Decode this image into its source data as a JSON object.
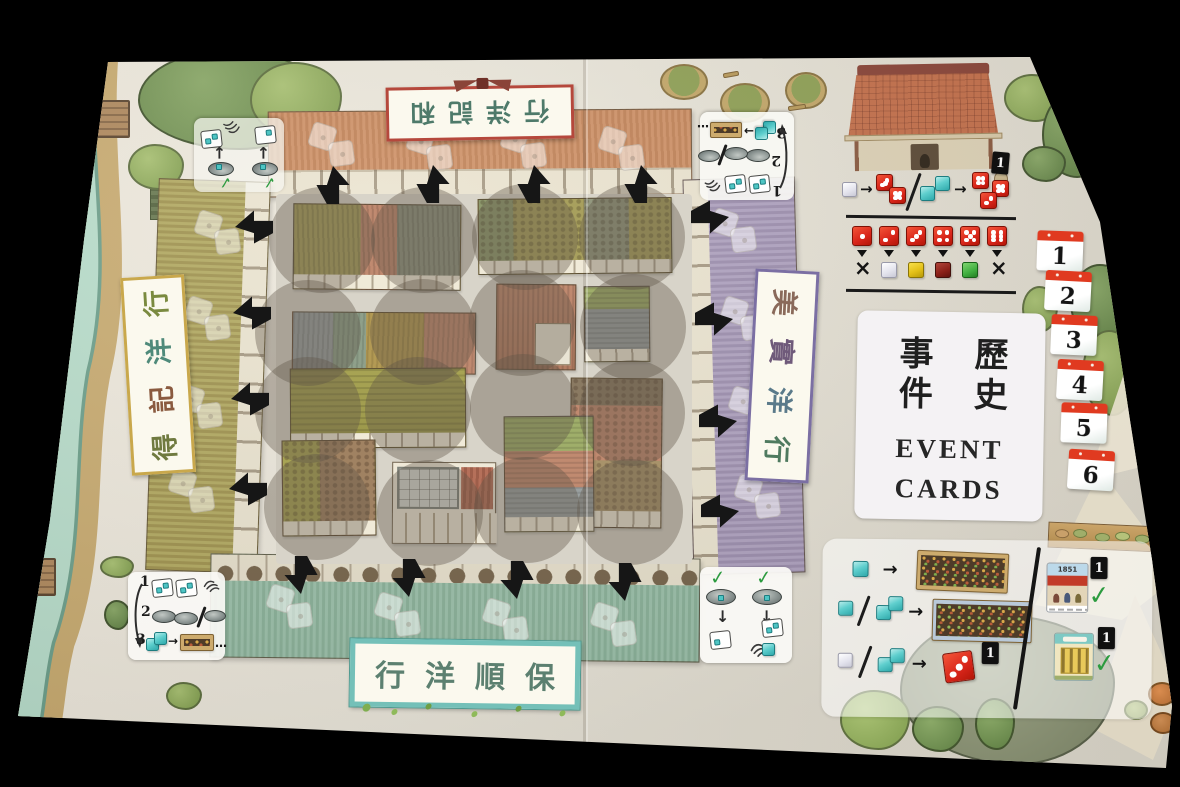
{
  "banners": {
    "top": {
      "display": "行洋記和",
      "company": "和記洋行"
    },
    "left": {
      "chars": [
        "行",
        "洋",
        "記",
        "得"
      ],
      "company": "得記洋行"
    },
    "right": {
      "chars": [
        "美",
        "實",
        "洋",
        "行"
      ],
      "company": "美實洋行"
    },
    "bottom": {
      "display": "行洋順保",
      "company": "保順洋行"
    }
  },
  "event_card": {
    "zh_left": "事件",
    "zh_right": "歷史",
    "en_line1": "EVENT",
    "en_line2": "CARDS"
  },
  "round_track": {
    "numbers": [
      "1",
      "2",
      "3",
      "4",
      "5",
      "6"
    ],
    "header_color": "#e03a20"
  },
  "marker_tile": {
    "value": "1"
  },
  "history_card": {
    "title": "1851"
  },
  "turn_reference": {
    "steps": [
      "1",
      "2",
      "3"
    ]
  },
  "glyphs": {
    "check": "✓",
    "cross": "×",
    "arrow_right": "→",
    "arrow_up": "↑",
    "arrow_down": "↓",
    "ellipsis": "…"
  },
  "dice_chart": {
    "exchange_row": {
      "left": "1 white cube gives 2 red dice",
      "right": "2 cyan cubes give 3 red dice"
    },
    "result_row": {
      "faces": [
        1,
        2,
        3,
        4,
        5,
        6
      ],
      "results": [
        "none",
        "white-cube",
        "yellow-cube",
        "dark-red-cube",
        "green-cube",
        "none"
      ]
    }
  },
  "scoring_reference": {
    "rows": [
      {
        "cost": "1 cyan cube",
        "reward": "small shophouse card"
      },
      {
        "cost": "1 cyan or 2 cyan cubes",
        "reward": "large shophouse card"
      },
      {
        "cost": "1 white or 2 cyan cubes",
        "reward": "red die plus 1 marker"
      }
    ],
    "right_column": [
      {
        "card": "1851 building card",
        "marker": "1"
      },
      {
        "card": "yellow building card",
        "marker": "1"
      }
    ]
  },
  "colors": {
    "board": "#e9e5da",
    "die_red": "#d8251a",
    "cube_cyan": "#4fc3c3",
    "arrow_black": "#161616",
    "check_green": "#2c9b3f",
    "tile_red": "#e03a20"
  }
}
